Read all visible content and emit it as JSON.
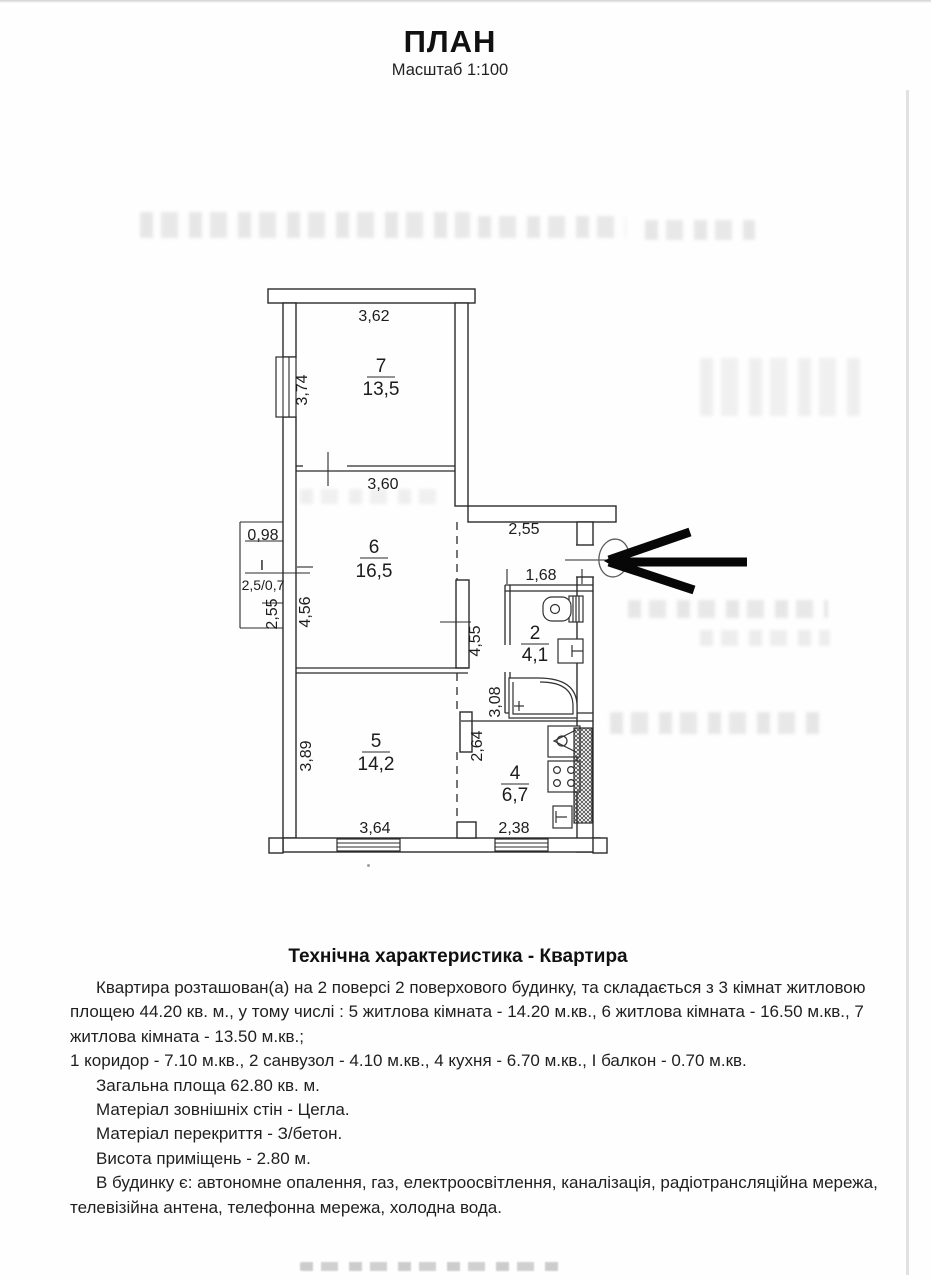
{
  "page": {
    "title": "ПЛАН",
    "scale_label": "Масштаб 1:100"
  },
  "plan": {
    "rooms": {
      "room7": {
        "number": "7",
        "area": "13,5"
      },
      "room6": {
        "number": "6",
        "area": "16,5"
      },
      "room2": {
        "number": "2",
        "area": "4,1"
      },
      "room5": {
        "number": "5",
        "area": "14,2"
      },
      "room4": {
        "number": "4",
        "area": "6,7"
      },
      "balcony": {
        "number": "І",
        "area": "2,5/0,7"
      }
    },
    "dims": {
      "room7_width": "3,62",
      "room7_height": "3,74",
      "room6_width": "3,60",
      "room6_height": "4,56",
      "balcony_width": "0,98",
      "balcony_height": "2,55",
      "hall_width": "2,55",
      "bath_width": "1,68",
      "hall_height": "4,55",
      "bath_height": "3,08",
      "room5_height": "3,89",
      "kitchen_height": "2,64",
      "room5_width": "3,64",
      "kitchen_width": "2,38"
    }
  },
  "specs": {
    "heading": "Технічна характеристика - Квартира",
    "paragraphs": [
      "Квартира розташован(а) на 2 поверсі 2 поверхового будинку, та складається з 3 кімнат житловою площею 44.20 кв. м., у тому числі : 5 житлова кімната - 14.20 м.кв., 6 житлова кімната - 16.50 м.кв., 7 житлова кімната - 13.50 м.кв.;",
      "1 коридор - 7.10 м.кв., 2 санвузол - 4.10 м.кв., 4 кухня - 6.70 м.кв., І балкон - 0.70 м.кв.",
      "Загальна площа 62.80 кв. м.",
      "Матеріал зовнішніх стін - Цегла.",
      "Матеріал перекриття - З/бетон.",
      "Висота приміщень - 2.80 м.",
      "В будинку є: автономне опалення, газ, електроосвітлення, каналізація, радіотрансляційна мережа, телевізійна антена, телефонна мережа, холодна вода."
    ]
  },
  "colors": {
    "ink": "#1c1c1c",
    "wall": "#2b2b2b",
    "arrow": "#070707"
  }
}
